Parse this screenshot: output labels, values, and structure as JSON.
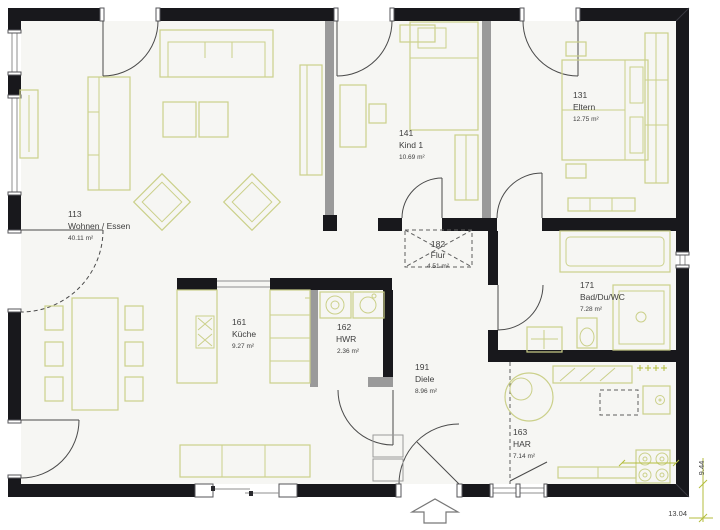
{
  "plan": {
    "title": "floor-plan",
    "rooms": [
      {
        "id": "113",
        "name": "Wohnen / Essen",
        "area": "40.11 m²"
      },
      {
        "id": "141",
        "name": "Kind 1",
        "area": "10.69 m²"
      },
      {
        "id": "131",
        "name": "Eltern",
        "area": "12.75 m²"
      },
      {
        "id": "182",
        "name": "Flur",
        "area": "4.51 m²"
      },
      {
        "id": "161",
        "name": "Küche",
        "area": "9.27 m²"
      },
      {
        "id": "162",
        "name": "HWR",
        "area": "2.36 m²"
      },
      {
        "id": "191",
        "name": "Diele",
        "area": "8.96 m²"
      },
      {
        "id": "171",
        "name": "Bad/Du/WC",
        "area": "7.28 m²"
      },
      {
        "id": "163",
        "name": "HAR",
        "area": "7.14 m²"
      }
    ],
    "dimensions": {
      "width": "13.04",
      "height": "9.44"
    },
    "icons": {
      "entrance_arrow": "up-arrow-outline"
    },
    "colors": {
      "wall": "#18181c",
      "interior_wall": "#9a9a9a",
      "furniture": "#cbd08a",
      "dimension": "#b4bd3c",
      "floor": "#f6f6f3",
      "text": "#3e3e3e"
    }
  }
}
